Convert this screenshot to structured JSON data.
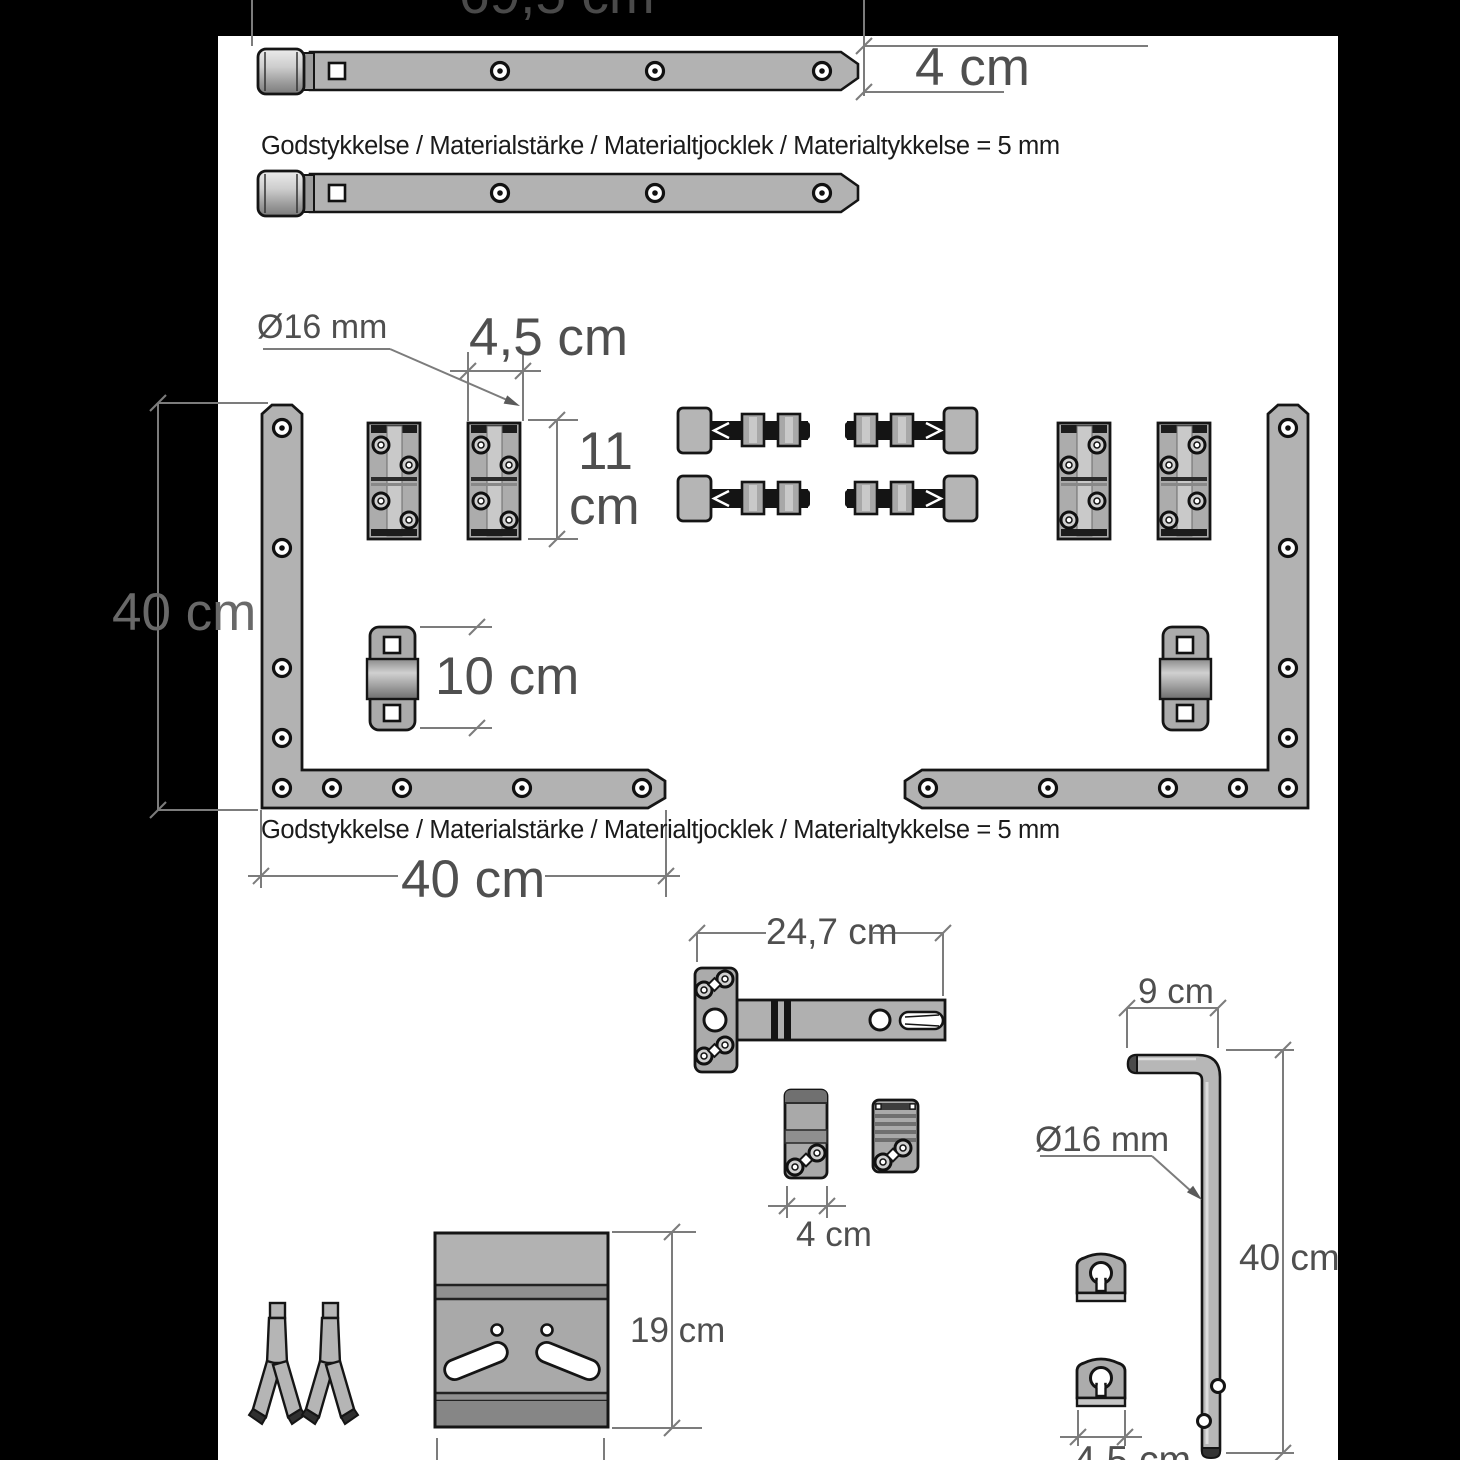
{
  "labels": {
    "top_length": "69,5 cm",
    "strap_width": "4 cm",
    "material_note_top": "Godstykkelse / Materialstärke / Materialtjocklek / Materialtykkelse = 5 mm",
    "hinge_pin_diameter": "Ø16 mm",
    "hinge_width": "4,5 cm",
    "hinge_height_value": "11",
    "hinge_height_unit": "cm",
    "bracket_height": "40 cm",
    "keeper_length": "10 cm",
    "material_note_bottom": "Godstykkelse / Materialstärke / Materialtjocklek / Materialtykkelse = 5 mm",
    "bracket_length": "40 cm",
    "latch_length": "24,7 cm",
    "latch_plate_width": "4 cm",
    "drop_bolt_arm": "9 cm",
    "drop_bolt_diameter": "Ø16 mm",
    "drop_bolt_length": "40 cm",
    "plate_height": "19 cm",
    "guide_width": "4,5 cm"
  },
  "colors": {
    "background": "#000000",
    "panel": "#ffffff",
    "part_fill": "#b0b0b0",
    "part_outline": "#151515",
    "dimension_lines": "#7c7c7c",
    "dimension_text": "#4f4f4f",
    "note_text": "#1b1b1b"
  }
}
